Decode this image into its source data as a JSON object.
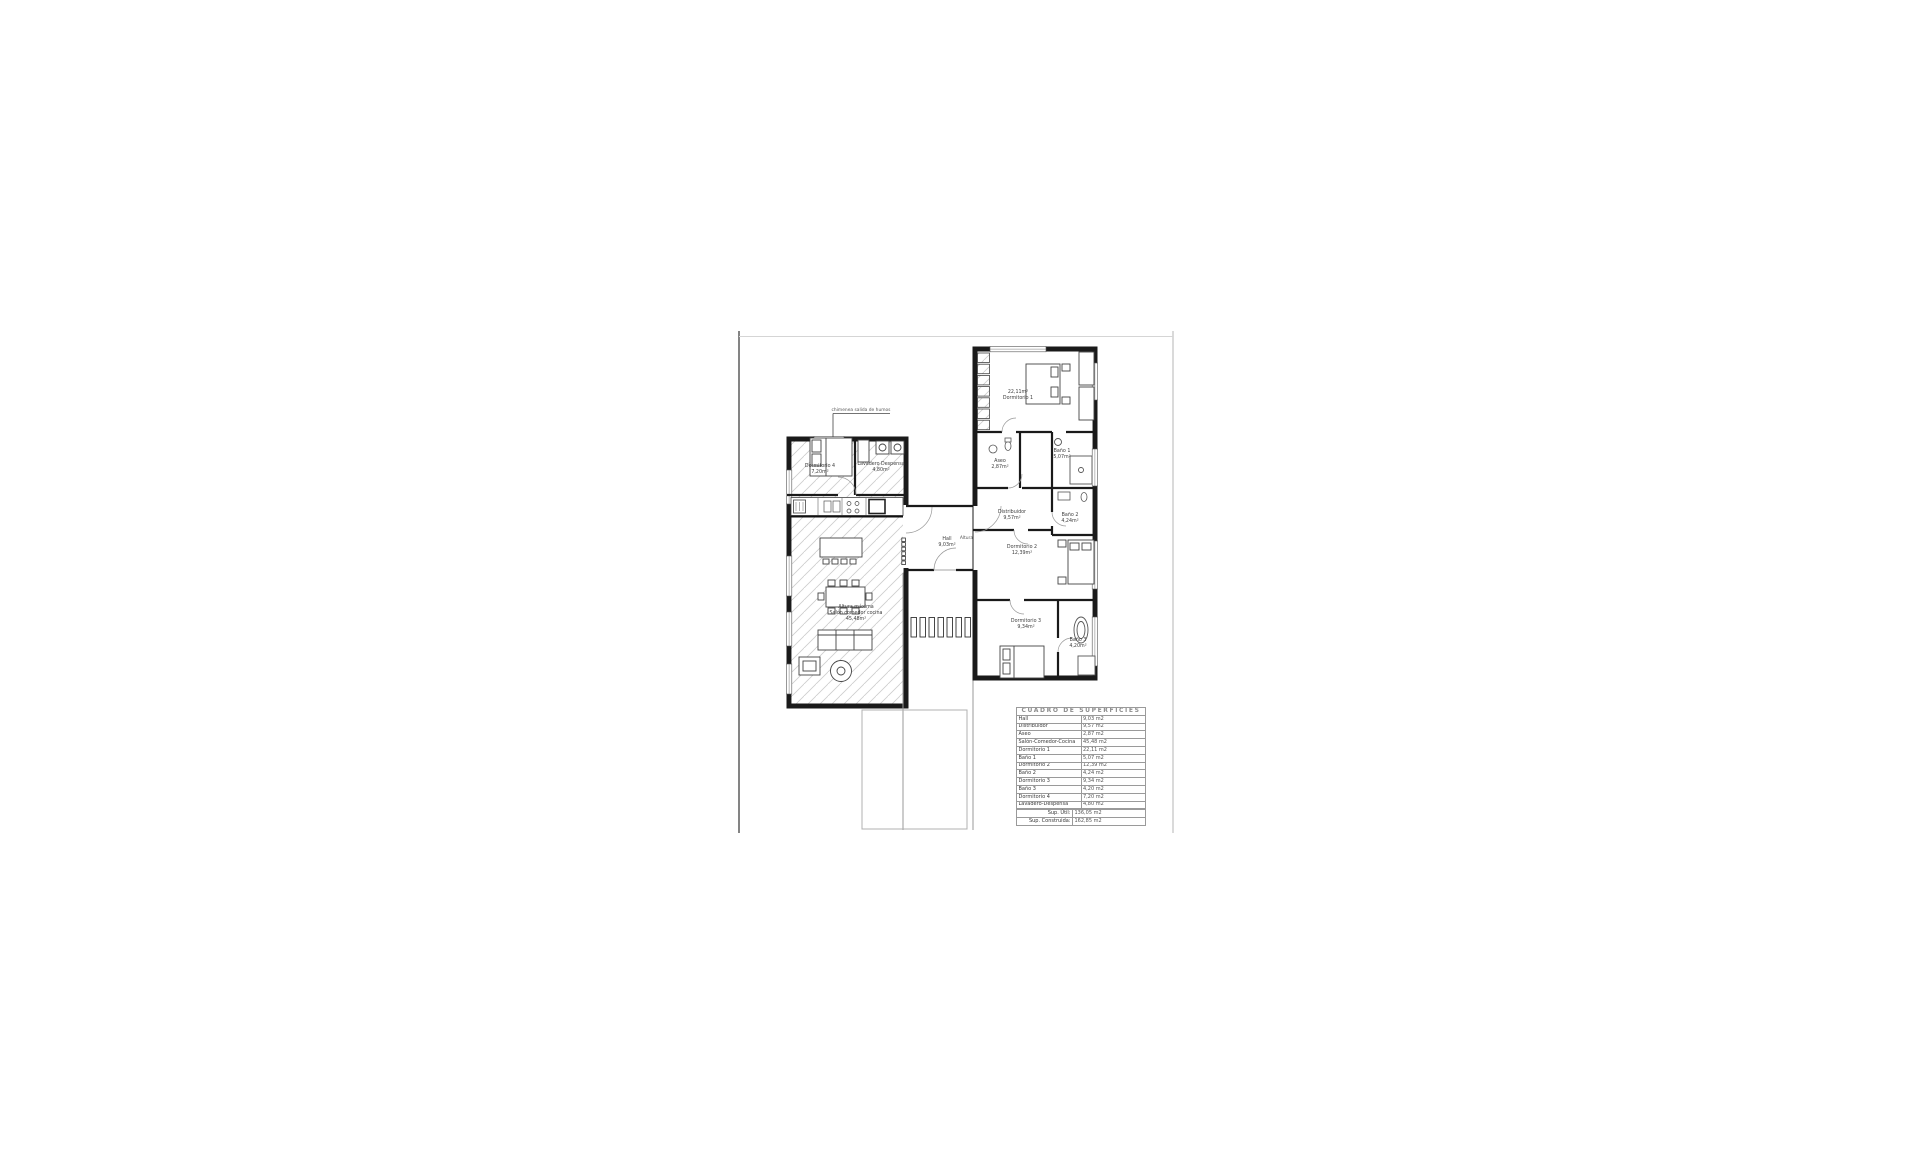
{
  "colors": {
    "wall": "#1a1a1a",
    "hatch": "#cdcdcd",
    "annotation": "#555555",
    "background": "#ffffff"
  },
  "drawing": {
    "annotations": {
      "chimenea": "chimenea salida de humos",
      "altura_hall": "Altura +3,50m"
    },
    "rooms": {
      "dormitorio4": {
        "name": "Dormitorio 4",
        "area": "7,20m²"
      },
      "lavadero": {
        "name": "Lavadero Despensa",
        "area": "4,80m²"
      },
      "salon": {
        "note": "Altura máxima",
        "name": "Salón comedor cocina",
        "area": "45,48m²"
      },
      "hall": {
        "name": "Hall",
        "area": "9,03m²"
      },
      "dormitorio1": {
        "name": "Dormitorio 1",
        "area": "22,11m²"
      },
      "aseo": {
        "name": "Aseo",
        "area": "2,87m²"
      },
      "bano1": {
        "name": "Baño 1",
        "area": "5,07m²"
      },
      "distribuidor": {
        "name": "Distribuidor",
        "area": "9,57m²"
      },
      "dormitorio2": {
        "name": "Dormitorio 2",
        "area": "12,39m²"
      },
      "bano2": {
        "name": "Baño 2",
        "area": "4,24m²"
      },
      "dormitorio3": {
        "name": "Dormitorio 3",
        "area": "9,34m²"
      },
      "bano3": {
        "name": "Baño 3",
        "area": "4,20m²"
      }
    }
  },
  "table": {
    "title": "CUADRO DE SUPERFICIES",
    "rows": [
      {
        "label": "Hall",
        "value": "9,03 m2"
      },
      {
        "label": "Distribuidor",
        "value": "9,57 m2"
      },
      {
        "label": "Aseo",
        "value": "2,87 m2"
      },
      {
        "label": "Salón-Comedor-Cocina",
        "value": "45,48 m2"
      },
      {
        "label": "Dormitorio 1",
        "value": "22,11 m2"
      },
      {
        "label": "Baño 1",
        "value": "5,07 m2"
      },
      {
        "label": "Dormitorio 2",
        "value": "12,39 m2"
      },
      {
        "label": "Baño 2",
        "value": "4,24 m2"
      },
      {
        "label": "Dormitorio 3",
        "value": "9,34 m2"
      },
      {
        "label": "Baño 3",
        "value": "4,20 m2"
      },
      {
        "label": "Dormitorio 4",
        "value": "7,20 m2"
      },
      {
        "label": "Lavadero-Despensa",
        "value": "4,80 m2"
      }
    ],
    "totals": [
      {
        "label": "Sup. Útil:",
        "value": "136,05 m2"
      },
      {
        "label": "Sup. Construida:",
        "value": "162,85 m2"
      }
    ]
  }
}
